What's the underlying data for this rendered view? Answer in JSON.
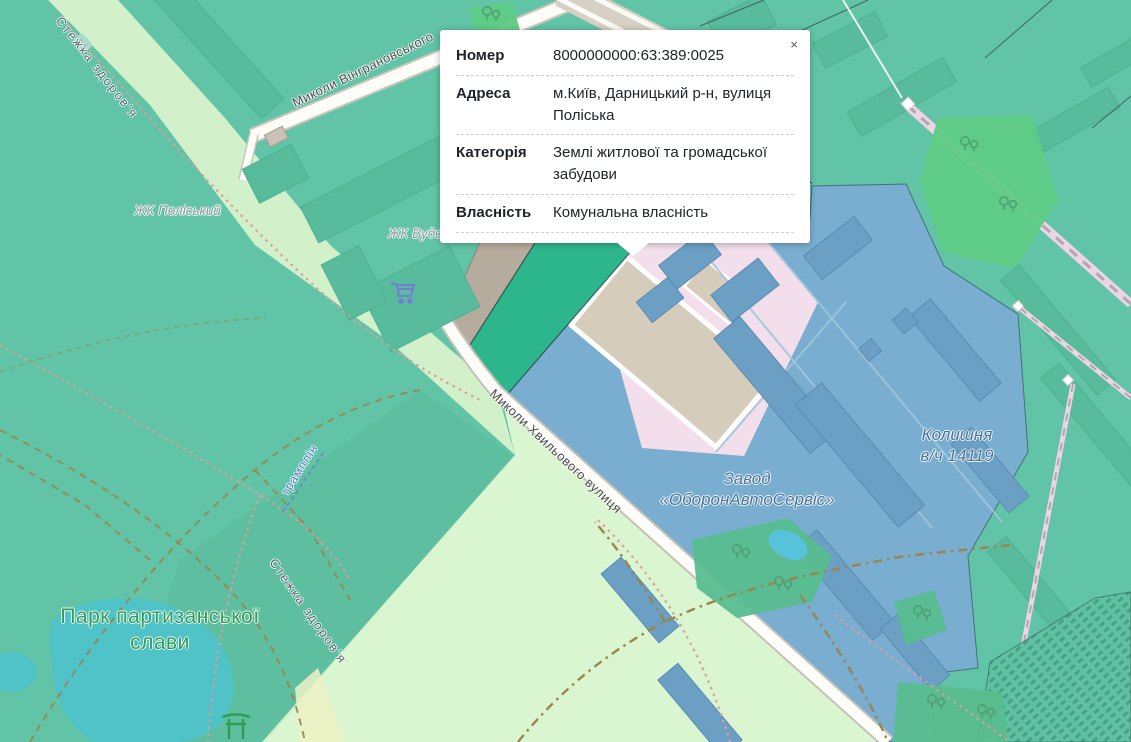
{
  "popup": {
    "close_label": "×",
    "rows": [
      {
        "label": "Номер",
        "value": "8000000000:63:389:0025"
      },
      {
        "label": "Адреса",
        "value": "м.Київ, Дарницький р-н, вулиця Поліська"
      },
      {
        "label": "Категорія",
        "value": "Землі житлової та громадської забудови"
      },
      {
        "label": "Власність",
        "value": "Комунальна власність"
      }
    ]
  },
  "map": {
    "labels": {
      "street_vingranovskogo": "Миколи Вінграновського",
      "street_khvylovogo": "Миколи Хвильового вулиця",
      "zhk_poliskyi": "ЖК Поліський",
      "zhk_vudstoriia": "ЖК Вудсторія",
      "zavod": "Завод\n«ОборонАвтоСервіс»",
      "former_military_unit": "Колишня\nв/ч 14119",
      "park": "Парк партизанської\nслави",
      "path_top": "Стежка здоров'я",
      "path_bottom": "Стежка здоров'я",
      "tramplin": "трамплін"
    },
    "colors": {
      "selected_parcel": "#2db68c",
      "zone_residential_blue": "#79aed0",
      "zone_teal": "#62c4a6",
      "park_light_green": "#d9f6d1",
      "water": "#4fc3c7",
      "road": "#ffffff",
      "popup_background": "#ffffff"
    }
  }
}
